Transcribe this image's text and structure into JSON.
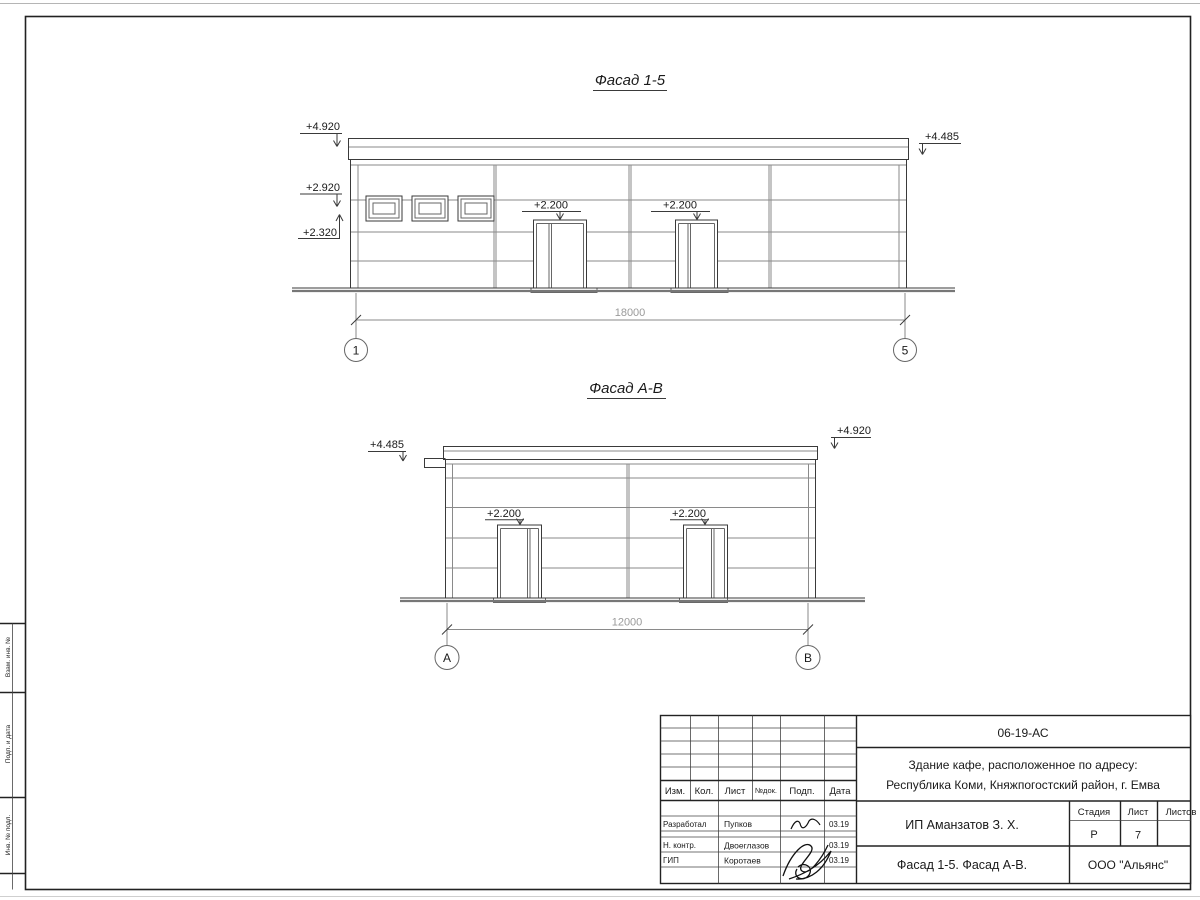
{
  "drawing": {
    "title_facade_15": "Фасад 1-5",
    "title_facade_ab": "Фасад А-В",
    "facade_15": {
      "elev_parapet_left": "+4.920",
      "elev_mid_left": "+2.920",
      "elev_low_left": "+2.320",
      "elev_door_1": "+2.200",
      "elev_door_2": "+2.200",
      "elev_parapet_right": "+4.485",
      "dim_total": "18000",
      "axis_start": "1",
      "axis_end": "5"
    },
    "facade_ab": {
      "elev_parapet_left": "+4.485",
      "elev_parapet_right": "+4.920",
      "elev_door_1": "+2.200",
      "elev_door_2": "+2.200",
      "dim_total": "12000",
      "axis_start": "А",
      "axis_end": "В"
    }
  },
  "side_stamp": {
    "box_top": "Взам. инв. №",
    "box_mid": "Подп. и дата",
    "box_bottom": "Инв. № подл."
  },
  "title_block": {
    "doc_code": "06-19-АС",
    "object_line1": "Здание кафе, расположенное по адресу:",
    "object_line2": "Республика Коми, Княжпогостский район, г. Емва",
    "col_izm": "Изм.",
    "col_kol": "Кол.",
    "col_list": "Лист",
    "col_ndoc": "№док.",
    "col_podp": "Подп.",
    "col_data": "Дата",
    "row_developer_role": "Разработал",
    "row_developer_name": "Пупков",
    "row_developer_date": "03.19",
    "row_ncontr_role": "Н. контр.",
    "row_ncontr_name": "Двоеглазов",
    "row_ncontr_date": "03.19",
    "row_gip_role": "ГИП",
    "row_gip_name": "Коротаев",
    "row_gip_date": "03.19",
    "client": "ИП Аманзатов З. Х.",
    "stage_label": "Стадия",
    "sheet_label": "Лист",
    "sheets_label": "Листов",
    "stage_value": "Р",
    "sheet_value": "7",
    "sheets_value": "",
    "sheet_title": "Фасад 1-5. Фасад А-В.",
    "company": "ООО \"Альянс\""
  }
}
